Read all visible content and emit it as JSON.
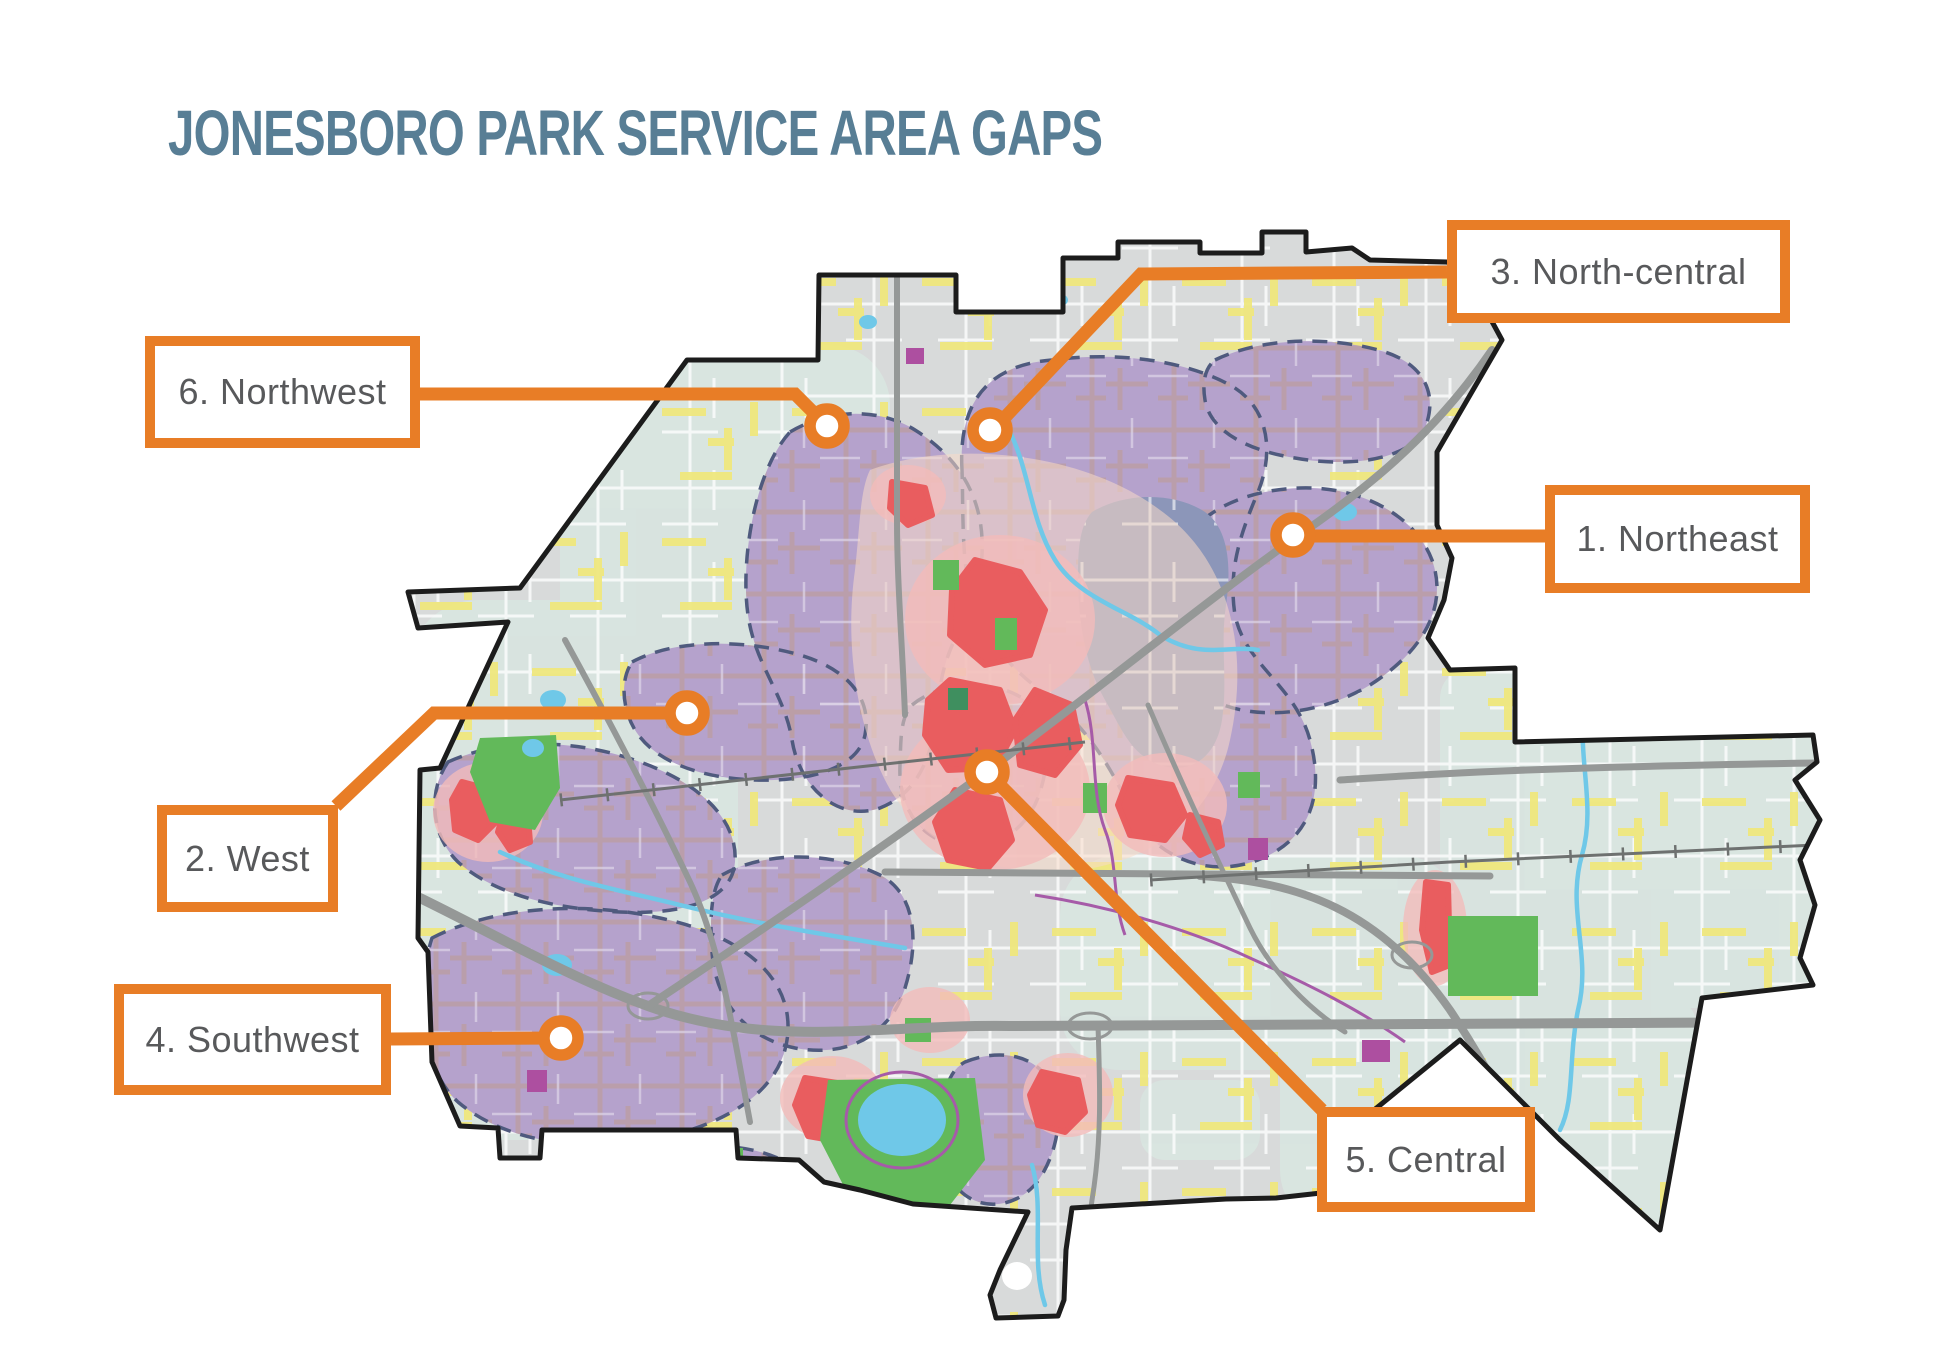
{
  "title": "JONESBORO PARK SERVICE AREA GAPS",
  "callouts": [
    {
      "id": 1,
      "label": "1. Northeast"
    },
    {
      "id": 2,
      "label": "2. West"
    },
    {
      "id": 3,
      "label": "3. North-central"
    },
    {
      "id": 4,
      "label": "4. Southwest"
    },
    {
      "id": 5,
      "label": "5. Central"
    },
    {
      "id": 6,
      "label": "6. Northwest"
    }
  ],
  "colors": {
    "accent_orange": "#E87D26",
    "title_slate_blue": "#587E95",
    "callout_text_gray": "#58595B",
    "service_gap_purple": "#B5A2CC",
    "gap_dashed_outline": "#4F5A7E",
    "high_need_red": "#E95D5F",
    "need_halo_pink": "#F3BCBA",
    "park_green": "#62B95A",
    "water_blue": "#6FC8E8",
    "minor_road_yellow": "#EFE77D",
    "major_road_gray": "#959897",
    "downtown_slate": "#8C96B9",
    "city_base_gray": "#D8DADA",
    "rural_tint_teal": "#D9E5E0",
    "city_outline_black": "#1C1C1C"
  }
}
